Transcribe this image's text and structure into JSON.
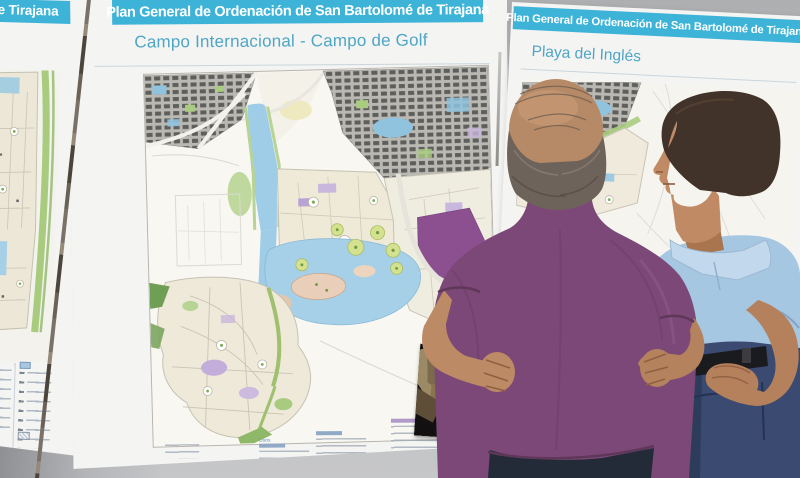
{
  "posters": {
    "left": {
      "header_partial": "e Tirajana"
    },
    "center": {
      "header": "Plan General de Ordenación de San Bartolomé de Tirajana",
      "title": "Campo Internacional - Campo de Golf"
    },
    "right": {
      "header": "Plan General de Ordenación de San Bartolomé de Tirajana",
      "title": "Playa del Inglés"
    }
  },
  "legend": {
    "center": {
      "group1_header": "Usos"
    }
  },
  "colors": {
    "header_bar": "#3db3d8",
    "title_text": "#4fa6c4",
    "purple_polo": "#7c4877",
    "blue_polo": "#a6c7e2"
  },
  "labels": {
    "scene": "Two men studying development plan posters on an exhibition wall",
    "man_purple": "Man in purple polo shirt seen from behind, hands on hips",
    "man_blue": "Man in light blue polo shirt viewed in profile",
    "aerial_photo": "Small aerial photo of rugged terrain",
    "campo_map": "Zoning map of Campo Internacional and Campo de Golf",
    "playa_map": "Zoning map of Playa del Inglés",
    "left_map": "Edge of an adjacent zoning map"
  }
}
